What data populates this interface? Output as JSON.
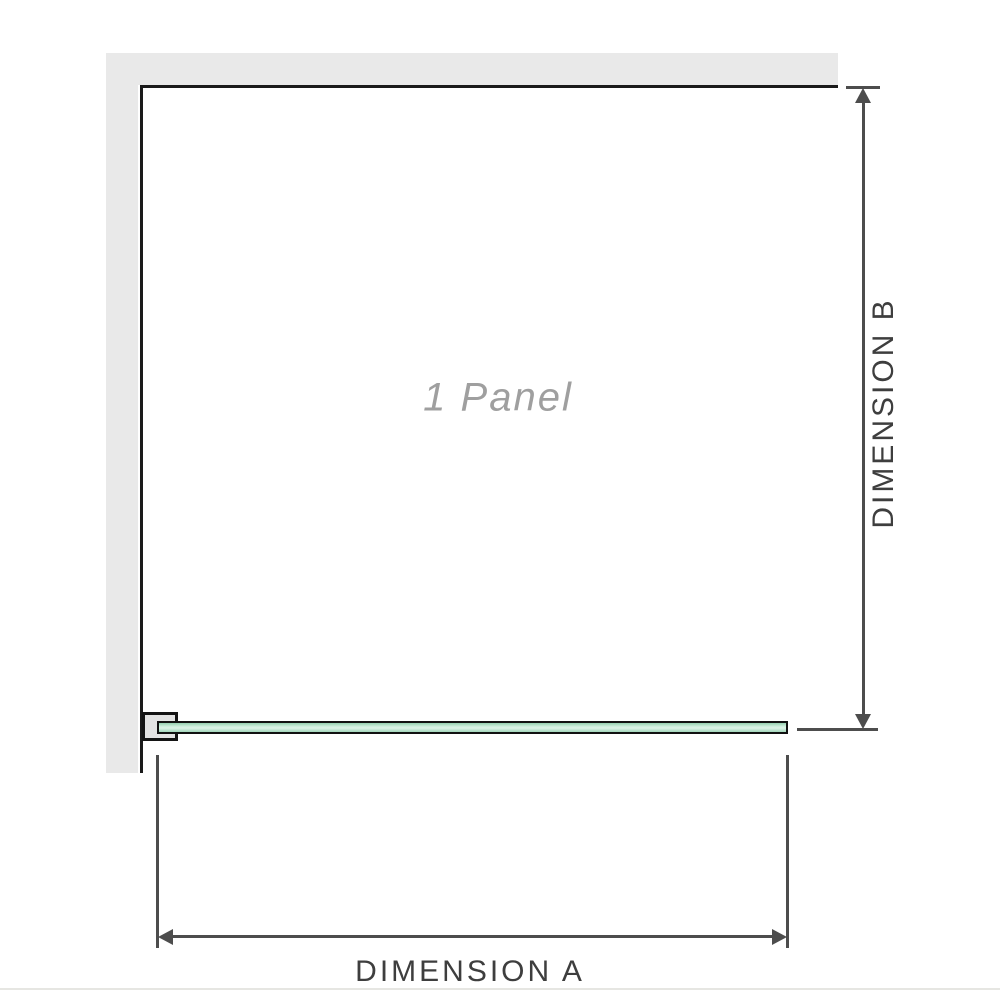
{
  "diagram": {
    "title": "shower-screen-panel-plan-diagram",
    "panel_label": "1 Panel",
    "dimension_a_label": "DIMENSION A",
    "dimension_b_label": "DIMENSION B",
    "panel_count": 1
  },
  "colors": {
    "background": "#ffffff",
    "wall_gray": "#e9e9e9",
    "outline_black": "#1a1a1a",
    "dimension_gray": "#4d4d4d",
    "label_dark_gray": "#3e3e3e",
    "watermark_gray": "#9f9f9f",
    "glass_green_edge": "#94ceae",
    "glass_green_light": "#ddf3e7",
    "bracket_fill": "#e3e3e3"
  }
}
